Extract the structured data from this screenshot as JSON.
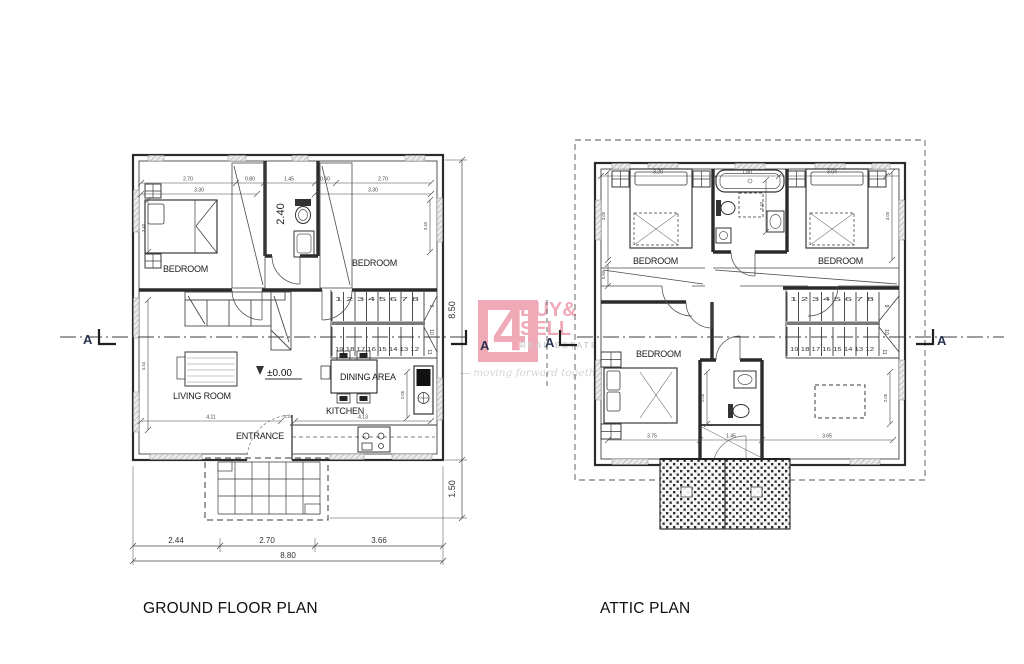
{
  "canvas": {
    "width": 1024,
    "height": 664,
    "background": "#ffffff"
  },
  "colors": {
    "wall": "#2b2b2b",
    "thin_line": "#555555",
    "dim_line": "#454545",
    "window_fill": "#ececec",
    "window_hatch": "#9f9f9f",
    "marker_blue": "#2a3550",
    "logo_pink": "#f0a9b7",
    "logo_gray": "#cfd0d0",
    "tagline_gray": "#d4d4d4"
  },
  "logo": {
    "number": "4",
    "line1": "BUY&",
    "line2": "SELL",
    "subtitle": "REAL ESTATE",
    "tagline": "moving forward together"
  },
  "section": {
    "marker": "A"
  },
  "ground": {
    "title": "GROUND FLOOR PLAN",
    "labels": {
      "bedroom_left": "BEDROOM",
      "bedroom_right": "BEDROOM",
      "living": "LIVING ROOM",
      "dining": "DINING AREA",
      "kitchen": "KITCHEN",
      "entrance": "ENTRANCE"
    },
    "level": "±0.00",
    "dims": {
      "top": [
        "2.70",
        "0.80",
        "1.45",
        "0.60",
        "2.70"
      ],
      "top2": [
        "3.30",
        "3.30"
      ],
      "bath_depth": "2.40",
      "left": [
        "3.40",
        "4.44"
      ],
      "right_inner": "3.40",
      "kitchen_width": "2.05",
      "inner_bottom": [
        "4.11",
        "0.24",
        "4.13"
      ],
      "height_total": "8.50",
      "porch_depth": "1.50",
      "bottom": [
        "2.44",
        "2.70",
        "3.66"
      ],
      "bottom_total": "8.80"
    },
    "stairs": {
      "top_run": "1 2 3 4 5 6 7 8",
      "bottom_run": "19 18 17 16 15 14 13 12",
      "winders": [
        "9",
        "10",
        "11"
      ]
    }
  },
  "attic": {
    "title": "ATTIC PLAN",
    "labels": {
      "bedroom_tl": "BEDROOM",
      "bedroom_tr": "BEDROOM",
      "bedroom_bl": "BEDROOM"
    },
    "dims": {
      "top": [
        "3.20",
        "1.80",
        "3.04"
      ],
      "left": [
        "3.00",
        "0.60"
      ],
      "right": "3.00",
      "bath_depth": "2.40",
      "bottom": [
        "3.75",
        "1.45",
        "3.65"
      ],
      "inner": [
        "2.05",
        "2.05"
      ]
    },
    "stairs": {
      "top_run": "1 2 3 4 5 6 7 8",
      "bottom_run": "19 18 17 16 15 14 13 12",
      "winders": [
        "9",
        "10",
        "11"
      ]
    }
  }
}
